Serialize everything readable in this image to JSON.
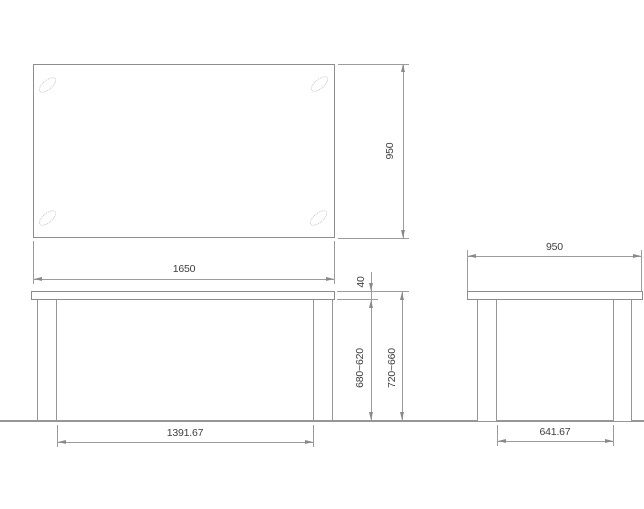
{
  "drawing": {
    "type": "table-orthographic-technical-drawing",
    "colors": {
      "background": "#ffffff",
      "outline": "#8d8d8d",
      "dimension_line": "#9c9c9c",
      "arrow": "#8a8a8a",
      "text": "#3f3f3f",
      "leg_ellipse": "#c3c3c3"
    },
    "top_view": {
      "width_label": "1650",
      "depth_label": "950"
    },
    "front_view": {
      "top_thickness_label": "40",
      "underside_height_label": "680~620",
      "total_height_label": "720~660",
      "leg_inner_span_label": "1391.67"
    },
    "side_view": {
      "depth_label": "950",
      "leg_inner_span_label": "641.67"
    }
  }
}
